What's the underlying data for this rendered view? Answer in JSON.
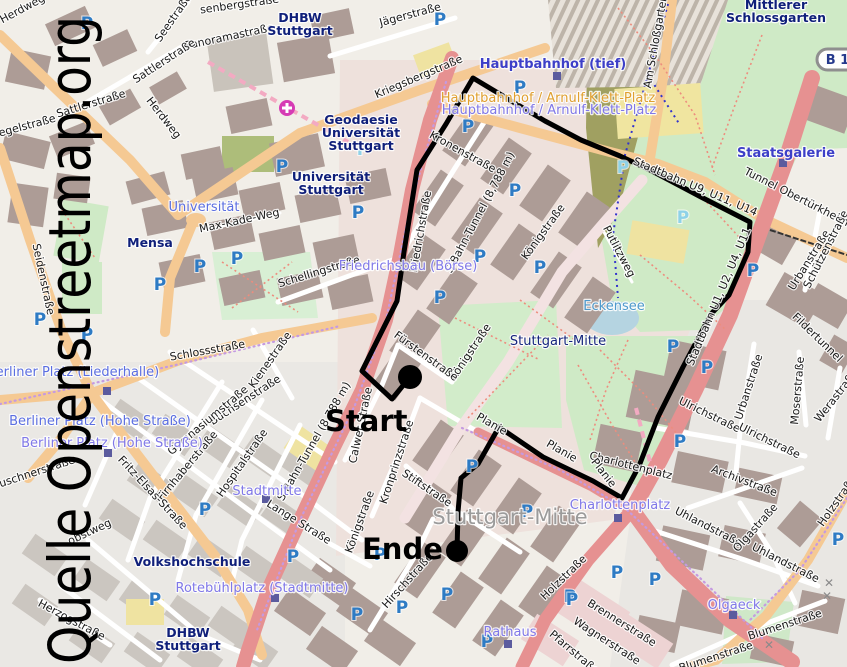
{
  "watermark": {
    "text": "Quelle Openstreetmap.org"
  },
  "road_badge": {
    "text": "B 14"
  },
  "route": {
    "start_label": "Start",
    "end_label": "Ende",
    "color": "#000000",
    "width": 5,
    "start_point": [
      410,
      377
    ],
    "end_point": [
      457,
      551
    ],
    "points": [
      [
        410,
        377
      ],
      [
        392,
        399
      ],
      [
        362,
        371
      ],
      [
        397,
        301
      ],
      [
        404,
        252
      ],
      [
        417,
        170
      ],
      [
        446,
        124
      ],
      [
        473,
        78
      ],
      [
        508,
        99
      ],
      [
        545,
        121
      ],
      [
        581,
        140
      ],
      [
        620,
        156
      ],
      [
        652,
        171
      ],
      [
        701,
        197
      ],
      [
        750,
        222
      ],
      [
        748,
        252
      ],
      [
        729,
        295
      ],
      [
        711,
        314
      ],
      [
        683,
        367
      ],
      [
        658,
        417
      ],
      [
        639,
        466
      ],
      [
        622,
        498
      ],
      [
        593,
        481
      ],
      [
        543,
        457
      ],
      [
        499,
        427
      ],
      [
        478,
        464
      ],
      [
        461,
        478
      ],
      [
        458,
        512
      ],
      [
        457,
        551
      ]
    ]
  },
  "colors": {
    "route": "#000000",
    "parking_blue": "#2e7bc4",
    "parking_cyan": "#8fd2e8",
    "street_label": "#191919",
    "poi": "#0f1f7a",
    "station_purple": "#8078e8",
    "station_blue": "#5b6ee1",
    "transit_bold_blue": "#3d3fc8",
    "transit_orange": "#e0a030",
    "water_label": "#4e99cc",
    "district_grey": "#9b9b9b",
    "district_navy": "#16267e",
    "marker_square": "#5b5b9e",
    "hospital": "#d63bb4",
    "crossing": "#8a8a8a"
  },
  "labels": {
    "streets": [
      {
        "n": "rosenbergstrasse",
        "t": "senbergstraße",
        "x": 240,
        "y": 8,
        "r": -8
      },
      {
        "n": "panoramastrasse",
        "t": "Panoramastraße",
        "x": 230,
        "y": 40,
        "r": -12
      },
      {
        "n": "jaegerstrasse",
        "t": "Jägerstraße",
        "x": 411,
        "y": 18,
        "r": -15
      },
      {
        "n": "seestrasse",
        "t": "Seestraße",
        "x": 176,
        "y": 20,
        "r": -55
      },
      {
        "n": "sattlerstrasse-1",
        "t": "Sattlerstraße",
        "x": 166,
        "y": 64,
        "r": -33
      },
      {
        "n": "sattlerstrasse-2",
        "t": "Sattlerstraße",
        "x": 92,
        "y": 107,
        "r": -17
      },
      {
        "n": "herdweg-1",
        "t": "Herdweg",
        "x": 24,
        "y": 12,
        "r": -28
      },
      {
        "n": "herdweg-2",
        "t": "Herdweg",
        "x": 161,
        "y": 120,
        "r": 52
      },
      {
        "n": "hegelstrasse",
        "t": "egelstraße",
        "x": 28,
        "y": 129,
        "r": -15
      },
      {
        "n": "seidenstrasse",
        "t": "Seidenstraße",
        "x": 40,
        "y": 280,
        "r": 78
      },
      {
        "n": "kriegsbergstrasse",
        "t": "Kriegsbergstraße",
        "x": 420,
        "y": 80,
        "r": -23,
        "fs": 12.5
      },
      {
        "n": "schellingstrasse",
        "t": "Schellingstraße",
        "x": 320,
        "y": 275,
        "r": -17
      },
      {
        "n": "friedrichstrasse",
        "t": "Friedrichstraße",
        "x": 424,
        "y": 232,
        "r": -80
      },
      {
        "n": "max-kade-weg",
        "t": "Max-Kade-Weg",
        "x": 240,
        "y": 224,
        "r": -12
      },
      {
        "n": "kronenstrasse",
        "t": "Kronenstraße",
        "x": 461,
        "y": 155,
        "r": 29
      },
      {
        "n": "s-bahn-tunnel-1",
        "t": "S-Bahn-Tunnel (8,788 m)",
        "x": 483,
        "y": 214,
        "r": -62
      },
      {
        "n": "koenigstrasse-1",
        "t": "Königstraße",
        "x": 546,
        "y": 234,
        "r": -54,
        "fs": 12
      },
      {
        "n": "koenigstrasse-2",
        "t": "Königstraße",
        "x": 473,
        "y": 354,
        "r": -56,
        "fs": 12
      },
      {
        "n": "koenigstrasse-3",
        "t": "Königstraße",
        "x": 363,
        "y": 523,
        "r": -70
      },
      {
        "n": "putlitzweg",
        "t": "Putlitzweg",
        "x": 616,
        "y": 253,
        "r": 62
      },
      {
        "n": "am-schlossgarten",
        "t": "Am Schloßgarten",
        "x": 659,
        "y": 42,
        "r": -80
      },
      {
        "n": "tunnel-obertuerkheim",
        "t": "Tunnel Obertürkheim",
        "x": 795,
        "y": 200,
        "r": 27,
        "fs": 12.5
      },
      {
        "n": "stadtbahn-u9-u11-u14",
        "t": "Stadtbahn U9, U11, U14",
        "x": 694,
        "y": 190,
        "r": 23
      },
      {
        "n": "stadtbahn-u1-u2-u4-u11",
        "t": "Stadtbahn U1, U2, U4, U11",
        "x": 722,
        "y": 298,
        "r": -67
      },
      {
        "n": "fuerstenstrasse",
        "t": "Fürstenstraße",
        "x": 424,
        "y": 359,
        "r": 36
      },
      {
        "n": "calwer-strasse",
        "t": "Calwer Straße",
        "x": 364,
        "y": 426,
        "r": -78
      },
      {
        "n": "kronprinzstrasse",
        "t": "Kronprinzstraße",
        "x": 400,
        "y": 463,
        "r": -72
      },
      {
        "n": "s-bahn-tunnel-2",
        "t": "S-Bahn-Tunnel (8,788 m)",
        "x": 317,
        "y": 443,
        "r": -60
      },
      {
        "n": "schlossstrasse",
        "t": "Schlossstraße",
        "x": 208,
        "y": 354,
        "r": -10,
        "fs": 12.5
      },
      {
        "n": "kienestrasse",
        "t": "Kienestraße",
        "x": 273,
        "y": 362,
        "r": -55
      },
      {
        "n": "buechsenstrasse",
        "t": "Büchsenstraße",
        "x": 247,
        "y": 403,
        "r": -33
      },
      {
        "n": "gymnasiumstrasse",
        "t": "Gymnasiumstraße",
        "x": 210,
        "y": 423,
        "r": -40
      },
      {
        "n": "firnhaberstrasse",
        "t": "Firnhaberstraße",
        "x": 190,
        "y": 468,
        "r": -50
      },
      {
        "n": "hospitalstrasse",
        "t": "Hospitalstraße",
        "x": 245,
        "y": 465,
        "r": -55
      },
      {
        "n": "fritz-elsas-strasse",
        "t": "Fritz-Elsas-Straße",
        "x": 150,
        "y": 495,
        "r": 47
      },
      {
        "n": "leuschnerstrasse",
        "t": "Leuschnerstraße",
        "x": 32,
        "y": 477,
        "r": -18
      },
      {
        "n": "herzogstrasse",
        "t": "Herzogstraße",
        "x": 70,
        "y": 623,
        "r": 28
      },
      {
        "n": "obstweg",
        "t": "obstweg",
        "x": 91,
        "y": 535,
        "r": -25
      },
      {
        "n": "lange-strasse",
        "t": "Lange Straße",
        "x": 297,
        "y": 525,
        "r": 32
      },
      {
        "n": "stiftstrasse",
        "t": "Stiftstraße",
        "x": 425,
        "y": 491,
        "r": 34
      },
      {
        "n": "hirschstrasse",
        "t": "Hirschstraße",
        "x": 410,
        "y": 583,
        "r": -48
      },
      {
        "n": "holzstrasse-1",
        "t": "Holzstraße",
        "x": 566,
        "y": 580,
        "r": -44
      },
      {
        "n": "holzstrasse-2",
        "t": "Holzstraße",
        "x": 840,
        "y": 503,
        "r": -55
      },
      {
        "n": "brennerstrasse",
        "t": "Brennerstraße",
        "x": 620,
        "y": 626,
        "r": 32
      },
      {
        "n": "wagnerstrasse",
        "t": "Wagnerstraße",
        "x": 605,
        "y": 644,
        "r": 33
      },
      {
        "n": "pfarrstrasse",
        "t": "Pfarrstraße",
        "x": 572,
        "y": 655,
        "r": 40
      },
      {
        "n": "uhlandstrasse-1",
        "t": "Uhlandstraße",
        "x": 707,
        "y": 530,
        "r": 27
      },
      {
        "n": "uhlandstrasse-2",
        "t": "Uhlandstraße",
        "x": 784,
        "y": 566,
        "r": 27
      },
      {
        "n": "ulrichstrasse-1",
        "t": "Ulrichstraße",
        "x": 708,
        "y": 418,
        "r": 26
      },
      {
        "n": "ulrichstrasse-2",
        "t": "Ulrichstraße",
        "x": 768,
        "y": 444,
        "r": 26
      },
      {
        "n": "archivstrasse",
        "t": "Archivstraße",
        "x": 743,
        "y": 484,
        "r": 21
      },
      {
        "n": "urbanstrasse-1",
        "t": "Urbanstraße",
        "x": 752,
        "y": 388,
        "r": -72
      },
      {
        "n": "urbanstrasse-2",
        "t": "Urbanstraße",
        "x": 812,
        "y": 262,
        "r": -58
      },
      {
        "n": "schuetzenstrasse",
        "t": "Schützenstraße",
        "x": 829,
        "y": 251,
        "r": -63
      },
      {
        "n": "moserstrasse",
        "t": "Moserstraße",
        "x": 801,
        "y": 391,
        "r": -85
      },
      {
        "n": "werastrasse",
        "t": "Werastraße",
        "x": 839,
        "y": 398,
        "r": -52
      },
      {
        "n": "fildertunnel",
        "t": "Fildertunnel",
        "x": 815,
        "y": 340,
        "r": 44
      },
      {
        "n": "olgastrasse",
        "t": "Olgastraße",
        "x": 758,
        "y": 530,
        "r": -48
      },
      {
        "n": "blumenstrasse-1",
        "t": "Blumenstraße",
        "x": 786,
        "y": 628,
        "r": -18
      },
      {
        "n": "blumenstrasse-2",
        "t": "Blumenstraße",
        "x": 717,
        "y": 660,
        "r": -18
      },
      {
        "n": "charlottenplatz-street",
        "t": "Charlottenplatz",
        "x": 630,
        "y": 469,
        "r": 14
      },
      {
        "n": "planie-1",
        "t": "Planie",
        "x": 490,
        "y": 427,
        "r": 30
      },
      {
        "n": "planie-2",
        "t": "Planie",
        "x": 560,
        "y": 454,
        "r": 30
      },
      {
        "n": "planie-3",
        "t": "Planie",
        "x": 601,
        "y": 475,
        "r": 52
      }
    ],
    "pois": [
      {
        "n": "dhbw-stuttgart-north",
        "lines": [
          "DHBW",
          "Stuttgart"
        ],
        "x": 300,
        "y": 22
      },
      {
        "n": "geodaesie-universitaet-stuttgart",
        "lines": [
          "Geodaesie",
          "Universität",
          "Stuttgart"
        ],
        "x": 361,
        "y": 124
      },
      {
        "n": "universitaet-stuttgart",
        "lines": [
          "Universität",
          "Stuttgart"
        ],
        "x": 331,
        "y": 181
      },
      {
        "n": "mensa",
        "lines": [
          "Mensa"
        ],
        "x": 150,
        "y": 247
      },
      {
        "n": "mittlerer-schlossgarten",
        "lines": [
          "Mittlerer",
          "Schlossgarten"
        ],
        "x": 776,
        "y": 9
      },
      {
        "n": "volkshochschule",
        "lines": [
          "Volkshochschule"
        ],
        "x": 192,
        "y": 566
      },
      {
        "n": "dhbw-stuttgart-south",
        "lines": [
          "DHBW",
          "Stuttgart"
        ],
        "x": 188,
        "y": 637
      }
    ],
    "stations": [
      {
        "n": "hauptbahnhof-tief",
        "t": "Hauptbahnhof (tief)",
        "x": 553,
        "y": 68,
        "c": "transit_bold_blue",
        "fs": 14.5,
        "b": true
      },
      {
        "n": "staatsgalerie",
        "t": "Staatsgalerie",
        "x": 786,
        "y": 157,
        "c": "transit_bold_blue",
        "fs": 15,
        "b": true
      },
      {
        "n": "hbf-arnulf-klett-platz-orange",
        "t": "Hauptbahnhof / Arnulf-Klett-Platz",
        "x": 548,
        "y": 102,
        "c": "transit_orange",
        "fs": 13
      },
      {
        "n": "hbf-arnulf-klett-platz-purple",
        "t": "Hauptbahnhof / Arnulf-Klett-Platz",
        "x": 549,
        "y": 114,
        "c": "station_purple",
        "fs": 13
      },
      {
        "n": "universitaet-station",
        "t": "Universität",
        "x": 204,
        "y": 211,
        "c": "station_blue",
        "fs": 13
      },
      {
        "n": "friedrichsbau-boerse",
        "t": "Friedrichsbau (Börse)",
        "x": 408,
        "y": 270,
        "c": "station_purple",
        "fs": 13
      },
      {
        "n": "berliner-platz-liederhalle",
        "t": "Berliner Platz (Liederhalle)",
        "x": 73,
        "y": 376,
        "c": "station_blue",
        "fs": 13
      },
      {
        "n": "berliner-platz-hohe-strasse-1",
        "t": "Berliner Platz (Hohe Straße)",
        "x": 100,
        "y": 425,
        "c": "station_blue",
        "fs": 13.5
      },
      {
        "n": "berliner-platz-hohe-strasse-2",
        "t": "Berliner Platz (Hohe Straße)",
        "x": 112,
        "y": 447,
        "c": "station_purple",
        "fs": 13.5
      },
      {
        "n": "stadtmitte",
        "t": "Stadtmitte",
        "x": 267,
        "y": 495,
        "c": "station_purple",
        "fs": 13
      },
      {
        "n": "rotebuehlplatz-stadtmitte",
        "t": "Rotebühlplatz (Stadtmitte)",
        "x": 262,
        "y": 592,
        "c": "station_purple",
        "fs": 13
      },
      {
        "n": "rathaus",
        "t": "Rathaus",
        "x": 510,
        "y": 636,
        "c": "station_purple",
        "fs": 14
      },
      {
        "n": "charlottenplatz-station",
        "t": "Charlottenplatz",
        "x": 620,
        "y": 509,
        "c": "station_purple",
        "fs": 13
      },
      {
        "n": "olgaeck",
        "t": "Olgaeck",
        "x": 734,
        "y": 609,
        "c": "station_purple",
        "fs": 13
      },
      {
        "n": "eckensee",
        "t": "Eckensee",
        "x": 614,
        "y": 310,
        "c": "water_label",
        "fs": 12
      }
    ],
    "districts": [
      {
        "n": "stuttgart-mitte-small",
        "t": "Stuttgart-Mitte",
        "x": 558,
        "y": 345,
        "fs": 13,
        "c": "district_navy"
      },
      {
        "n": "stuttgart-mitte-large",
        "t": "Stuttgart-Mitte",
        "x": 510,
        "y": 524,
        "fs": 21,
        "c": "district_grey"
      }
    ]
  },
  "parking": {
    "glyph": "P",
    "blue": [
      [
        87,
        29
      ],
      [
        440,
        25
      ],
      [
        520,
        93
      ],
      [
        282,
        172
      ],
      [
        358,
        218
      ],
      [
        200,
        272
      ],
      [
        237,
        264
      ],
      [
        160,
        290
      ],
      [
        468,
        132
      ],
      [
        515,
        196
      ],
      [
        480,
        262
      ],
      [
        540,
        273
      ],
      [
        753,
        276
      ],
      [
        440,
        303
      ],
      [
        673,
        352
      ],
      [
        707,
        373
      ],
      [
        680,
        447
      ],
      [
        472,
        472
      ],
      [
        527,
        517
      ],
      [
        447,
        600
      ],
      [
        402,
        613
      ],
      [
        357,
        620
      ],
      [
        293,
        562
      ],
      [
        380,
        560
      ],
      [
        487,
        647
      ],
      [
        570,
        602
      ],
      [
        617,
        578
      ],
      [
        655,
        585
      ],
      [
        572,
        605
      ],
      [
        205,
        515
      ],
      [
        155,
        605
      ],
      [
        40,
        325
      ],
      [
        87,
        340
      ],
      [
        838,
        545
      ]
    ],
    "cyan": [
      [
        363,
        155
      ],
      [
        623,
        173
      ],
      [
        683,
        223
      ]
    ]
  },
  "markers": {
    "station_squares": [
      [
        557,
        76
      ],
      [
        783,
        163
      ],
      [
        107,
        391
      ],
      [
        108,
        453
      ],
      [
        266,
        499
      ],
      [
        275,
        598
      ],
      [
        508,
        644
      ],
      [
        618,
        518
      ],
      [
        733,
        615
      ]
    ],
    "hospital": {
      "x": 287,
      "y": 108
    },
    "crossings": [
      [
        829,
        587
      ],
      [
        827,
        600
      ],
      [
        769,
        649
      ]
    ]
  }
}
